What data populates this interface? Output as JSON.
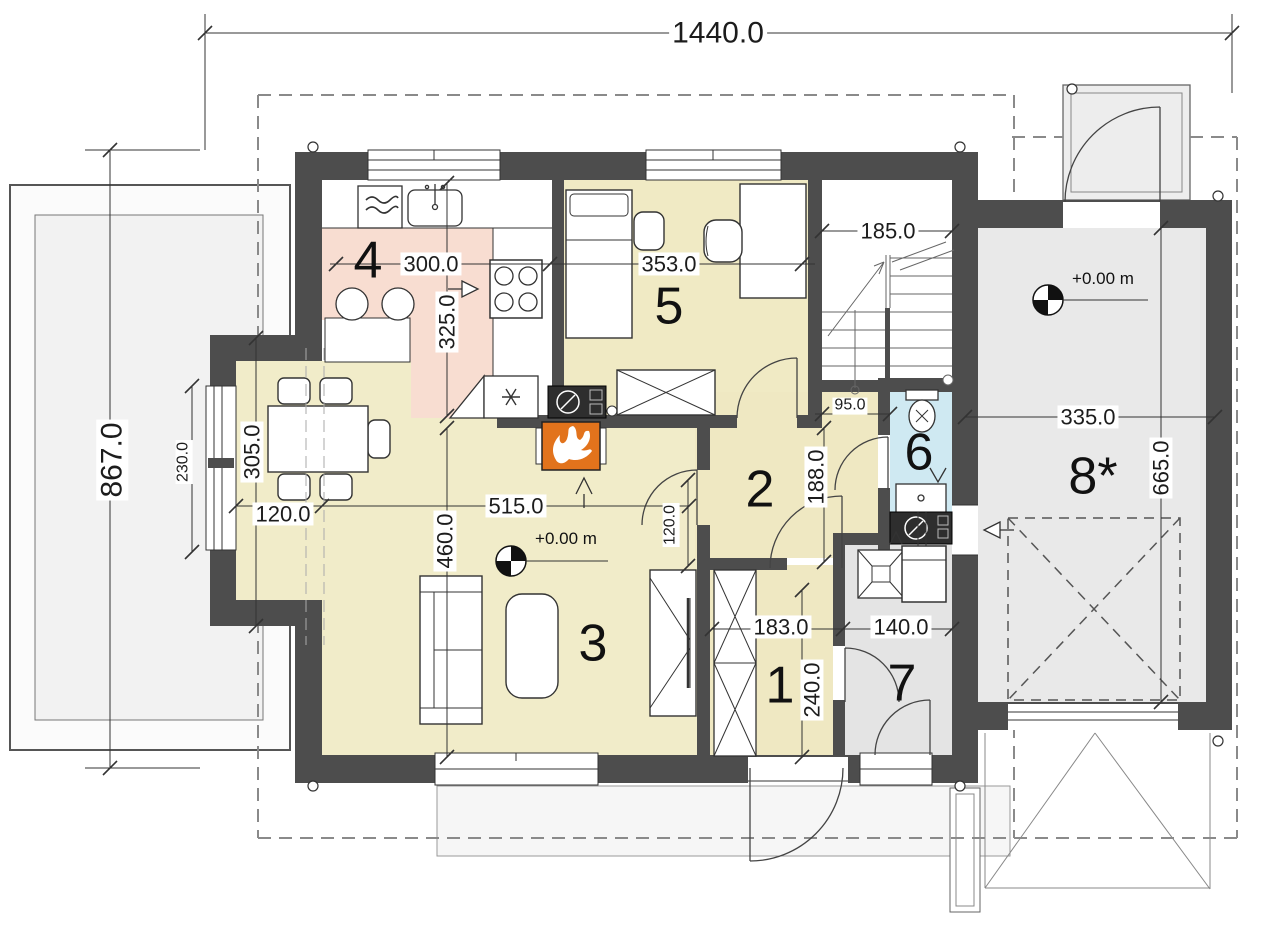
{
  "dims": {
    "overall_width": "1440.0",
    "overall_depth": "867.0",
    "kitchen_width": "300.0",
    "kitchen_depth": "325.0",
    "bedroom_width": "353.0",
    "stair_width": "185.0",
    "bay_depth": "305.0",
    "bay_window_width": "230.0",
    "bay_recess": "120.0",
    "living_width": "515.0",
    "living_depth": "460.0",
    "hall_depth": "188.0",
    "hall_passage": "120.0",
    "corridor_width": "95.0",
    "entry_width": "183.0",
    "entry_depth": "240.0",
    "tech_width": "140.0",
    "garage_width": "335.0",
    "garage_depth": "665.0"
  },
  "rooms": {
    "entry": "1",
    "hallway": "2",
    "living_room": "3",
    "kitchen": "4",
    "bedroom": "5",
    "bathroom": "6",
    "tech_room": "7",
    "garage": "8*"
  },
  "levels": {
    "ground_floor": "+0.00 m",
    "garage": "+0.00 m"
  },
  "colors": {
    "room_cream": "#f1ecc9",
    "kitchen_pink": "#f8ddd1",
    "bath_blue": "#cfe9f2",
    "garage_gray": "#e9e9e9",
    "tech_gray": "#e4e4e4",
    "wall_dark": "#4d4d4d",
    "fireplace_orange": "#e2731c"
  }
}
